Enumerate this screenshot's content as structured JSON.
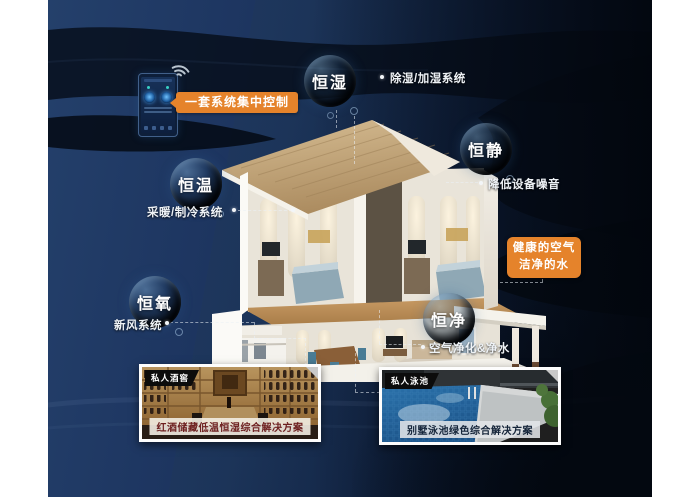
{
  "poster": {
    "theme": "smart home whole-house system infographic",
    "colors": {
      "accent_orange": "#E5832B",
      "background_navy": "#1D3560",
      "wave_dark": "#060D1A",
      "caption_wine_text": "#6D1F1F",
      "caption_pool_text": "#15253A"
    }
  },
  "icons": {
    "wifi": "wifi-icon",
    "phone": "smartphone-remote-control"
  },
  "callouts": {
    "control": "一套系统集中控制",
    "healthy_air": "健康的空气",
    "clean_water": "洁净的水"
  },
  "bubbles": [
    {
      "label": "恒湿",
      "sub": "除湿/加湿系统"
    },
    {
      "label": "恒静",
      "sub": "降低设备噪音"
    },
    {
      "label": "恒温",
      "sub": "采暖/制冷系统"
    },
    {
      "label": "恒氧",
      "sub": "新风系统"
    },
    {
      "label": "恒净",
      "sub": "空气净化&净水"
    }
  ],
  "cards": [
    {
      "badge": "私人酒窖",
      "caption": "红酒储藏低温恒湿综合解决方案"
    },
    {
      "badge": "私人泳池",
      "caption": "别墅泳池绿色综合解决方案"
    }
  ]
}
